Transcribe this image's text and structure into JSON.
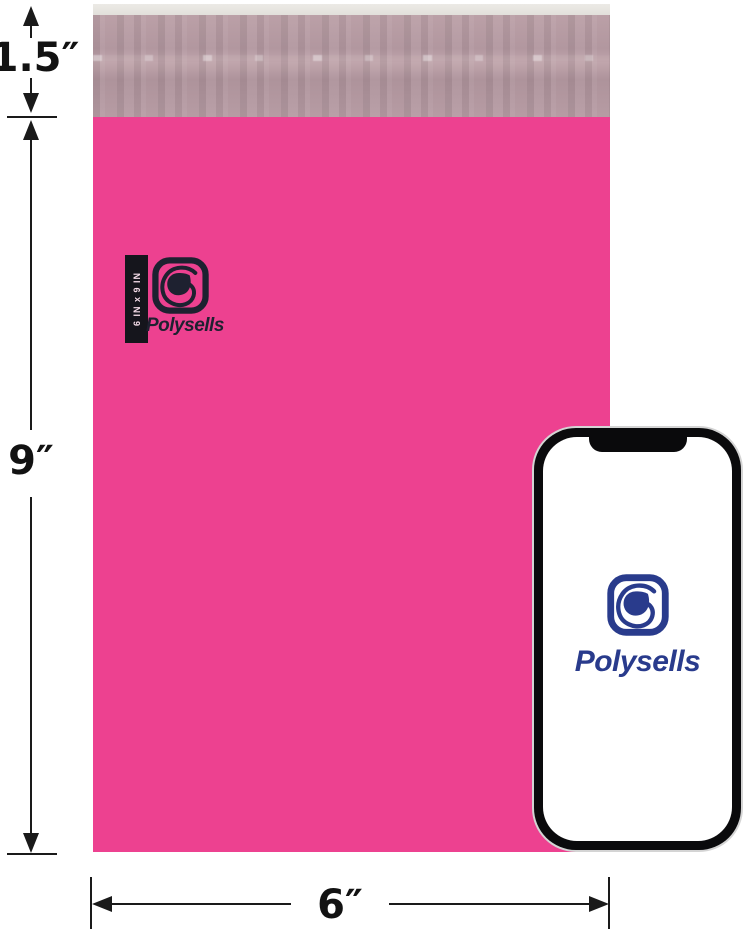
{
  "product_image": {
    "dimension_labels": {
      "flap_height": "1.5″",
      "bag_height": "9″",
      "bag_width": "6″"
    },
    "bag": {
      "brand": "Polysells",
      "size_tag": "6 IN x 9 IN",
      "body_color": "#ED4190",
      "flap_color": "#B59BA2",
      "flap_edge_color": "#E6E4E0",
      "print_color": "#1E2130"
    },
    "phone": {
      "brand": "Polysells",
      "logo_color": "#293B8C",
      "frame_color": "#0A0A0C",
      "screen_color": "#FFFFFF"
    }
  }
}
